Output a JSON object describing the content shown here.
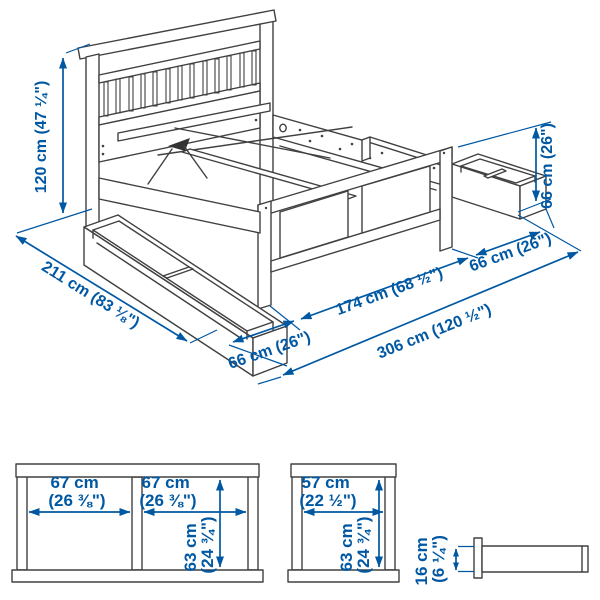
{
  "colors": {
    "line": "#404040",
    "dimension": "#0058a3",
    "background": "#ffffff"
  },
  "main_view": {
    "labels": {
      "headboard_height": "120 cm (47 ¼\")",
      "bed_length": "211 cm (83 ⅛\")",
      "left_box_extension": "66 cm (26\")",
      "bed_width": "174 cm (68 ½\")",
      "right_box_extension": "66 cm (26\")",
      "footboard_height": "66 cm (26\")",
      "total_width_with_boxes_out": "306 cm (120 ½\")"
    }
  },
  "detail_views": {
    "double_box_front": {
      "compartment1_width_l1": "67 cm",
      "compartment1_width_l2": "(26 ⅜\")",
      "compartment2_width_l1": "67 cm",
      "compartment2_width_l2": "(26 ⅜\")",
      "height_l1": "63 cm",
      "height_l2": "(24 ¾\")"
    },
    "single_box_front": {
      "width_l1": "57 cm",
      "width_l2": "(22 ½\")",
      "height_l1": "63 cm",
      "height_l2": "(24 ¾\")"
    },
    "box_side_view": {
      "height_l1": "16 cm",
      "height_l2": "(6 ¼\")"
    }
  }
}
